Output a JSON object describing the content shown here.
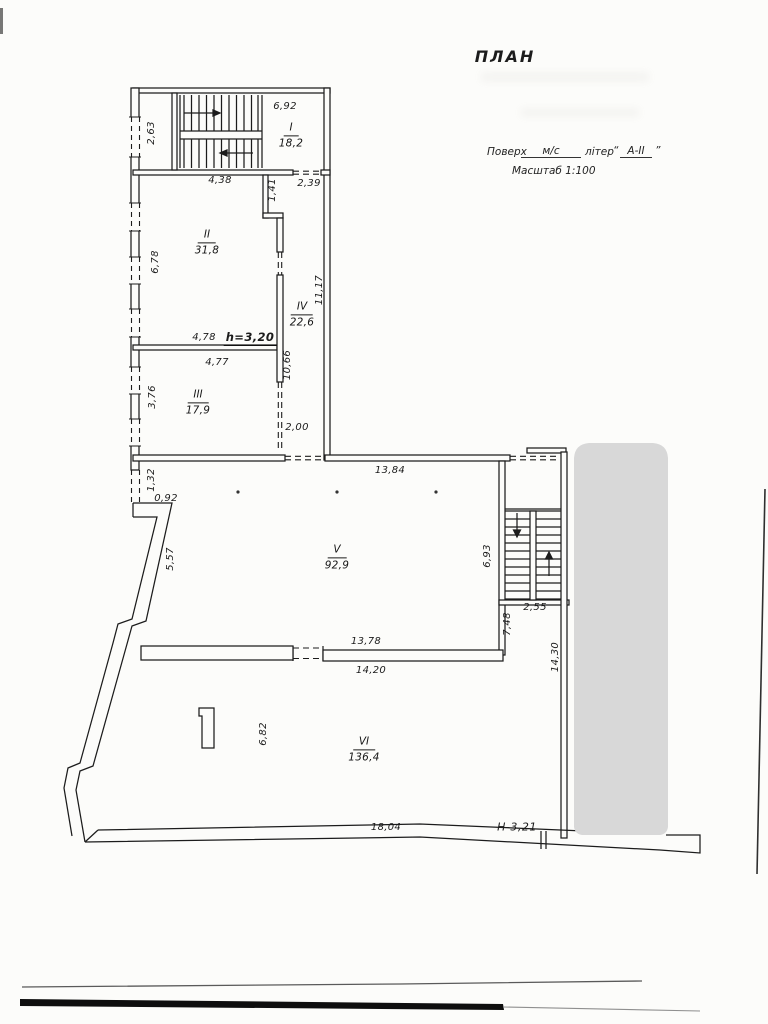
{
  "title": "ПЛАН",
  "header": {
    "floor_label": "Поверх",
    "floor_value": "м/с",
    "liter_label": "літер",
    "open_quote": "“",
    "liter_value": "А-ІІ",
    "close_quote": "”",
    "scale": "Масштаб 1:100"
  },
  "rooms": [
    {
      "numeral": "I",
      "area": "18,2"
    },
    {
      "numeral": "II",
      "area": "31,8"
    },
    {
      "numeral": "III",
      "area": "17,9"
    },
    {
      "numeral": "IV",
      "area": "22,6"
    },
    {
      "numeral": "V",
      "area": "92,9"
    },
    {
      "numeral": "VI",
      "area": "136,4"
    }
  ],
  "dimensions": {
    "d6_92": "6,92",
    "d2_63": "2,63",
    "d4_38": "4,38",
    "d1_41": "1,41",
    "d2_39": "2,39",
    "d6_78": "6,78",
    "d11_17": "11,17",
    "d4_78": "4,78",
    "d10_66": "10,66",
    "d4_77": "4,77",
    "d3_76": "3,76",
    "d2_00": "2,00",
    "d1_32": "1,32",
    "d0_92": "0,92",
    "d13_84": "13,84",
    "d5_57": "5,57",
    "d6_93": "6,93",
    "d2_55": "2,55",
    "d7_48": "7,48",
    "d14_30": "14,30",
    "d13_78": "13,78",
    "d14_20": "14,20",
    "d6_82": "6,82",
    "d18_04": "18,04"
  },
  "notes": {
    "height": "h=3,20",
    "level": "Н-3,21"
  },
  "colors": {
    "ink": "#1c1c1c",
    "redaction_gray": "#d8d8d8"
  }
}
